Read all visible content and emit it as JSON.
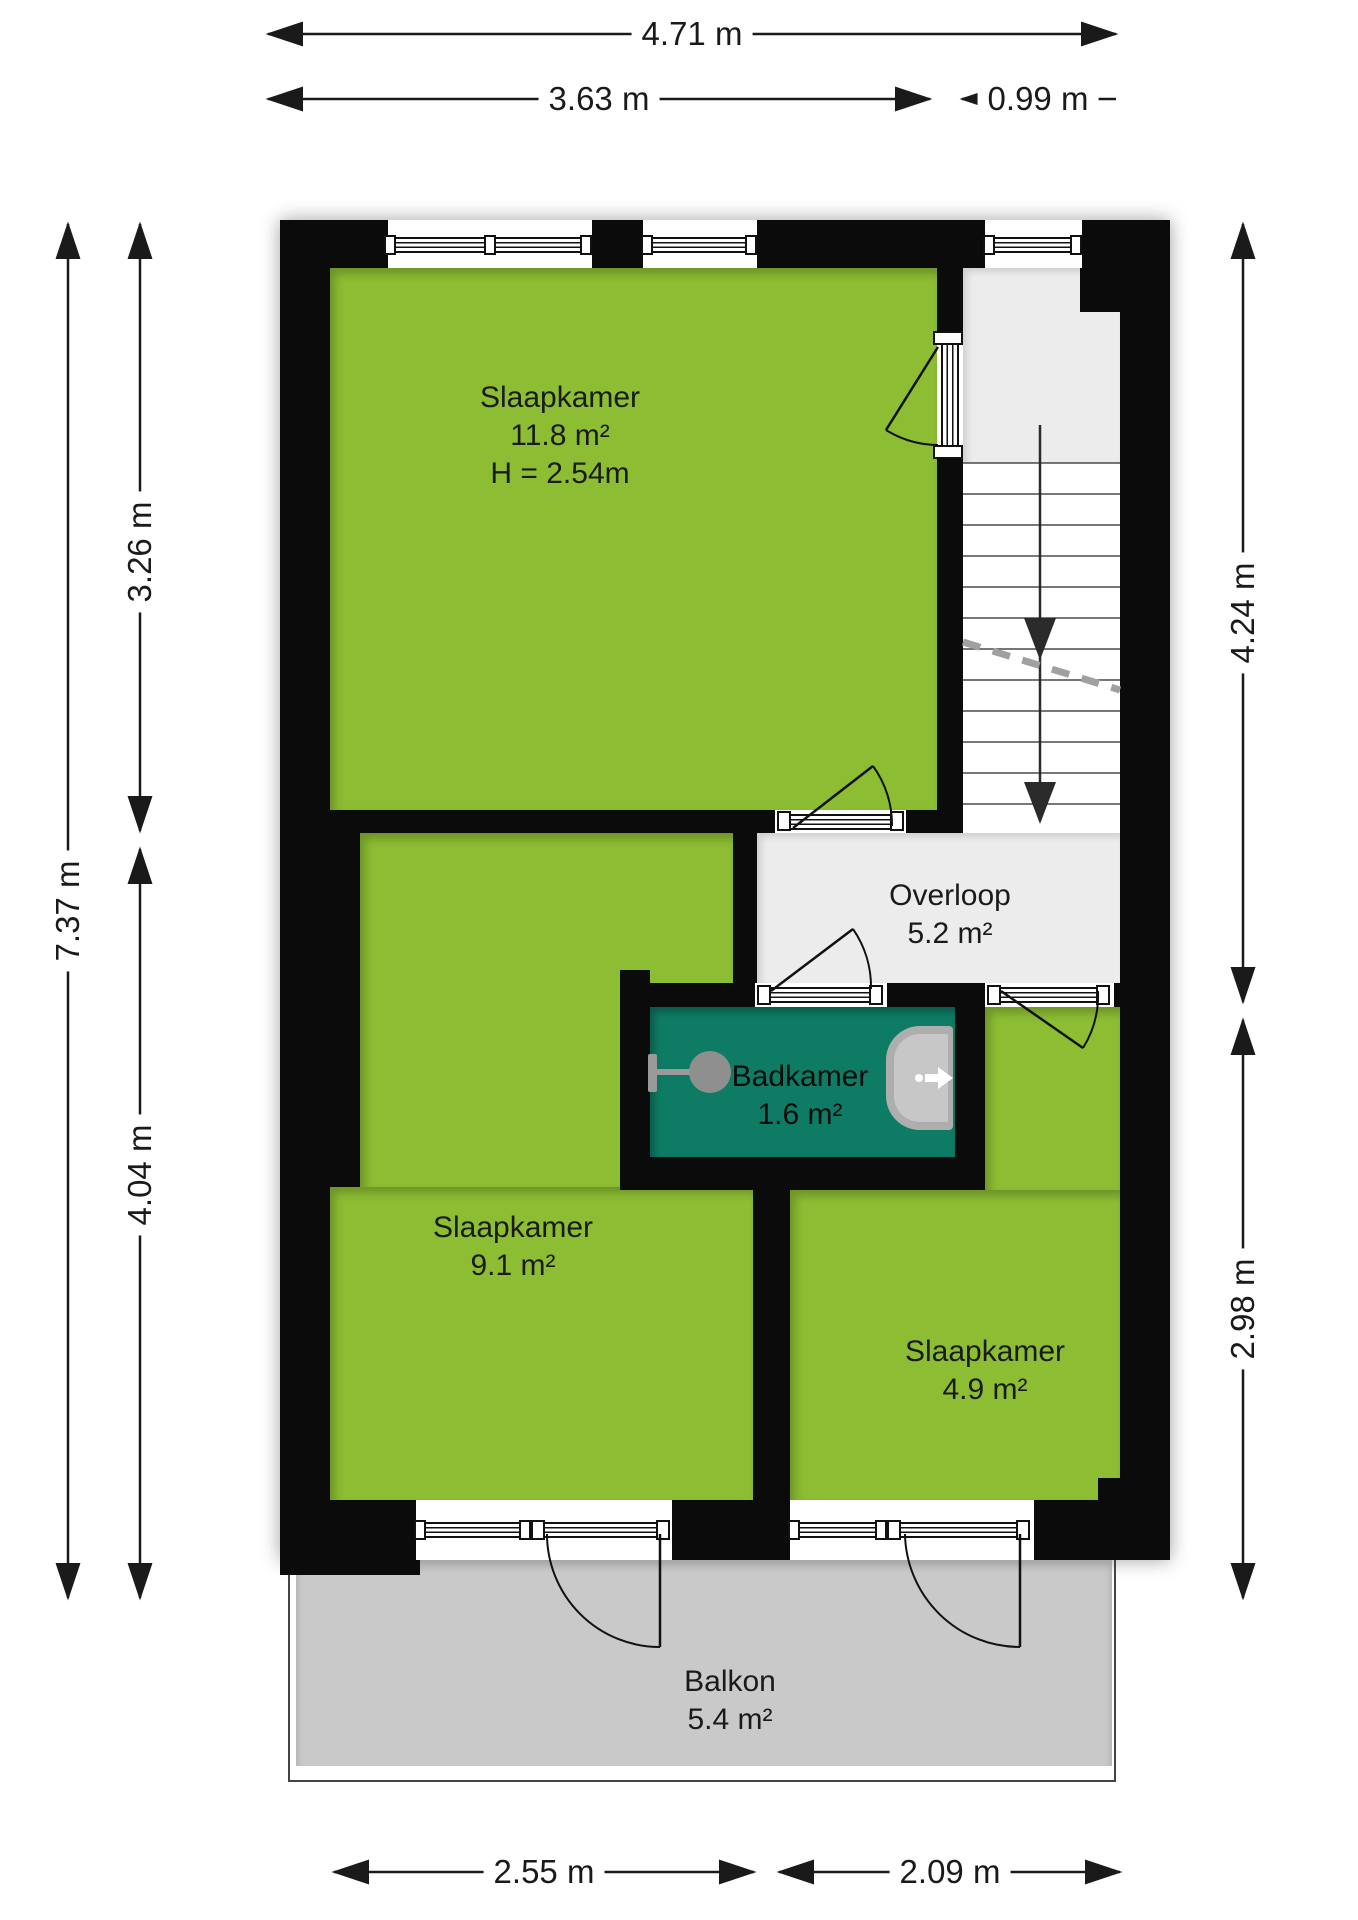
{
  "title": "Floor plan - verdieping",
  "colors": {
    "room_green": "#8cbd33",
    "bathroom_teal": "#0e7c64",
    "hallway_gray": "#ececec",
    "balcony_gray": "#c9c9c9",
    "wall_black": "#0b0b0b"
  },
  "rooms": {
    "slaapkamer1": {
      "name": "Slaapkamer",
      "area": "11.8 m²",
      "ceiling_height": "H = 2.54m"
    },
    "slaapkamer2": {
      "name": "Slaapkamer",
      "area": "9.1 m²"
    },
    "slaapkamer3": {
      "name": "Slaapkamer",
      "area": "4.9 m²"
    },
    "badkamer": {
      "name": "Badkamer",
      "area": "1.6 m²"
    },
    "overloop": {
      "name": "Overloop",
      "area": "5.2 m²"
    },
    "balkon": {
      "name": "Balkon",
      "area": "5.4 m²"
    }
  },
  "dimensions": {
    "top_total": "4.71 m",
    "top_left": "3.63 m",
    "top_right": "0.99 m",
    "left_total": "7.37 m",
    "left_upper": "3.26 m",
    "left_lower": "4.04 m",
    "right_upper": "4.24 m",
    "right_lower": "2.98 m",
    "bottom_left": "2.55 m",
    "bottom_right": "2.09 m"
  }
}
